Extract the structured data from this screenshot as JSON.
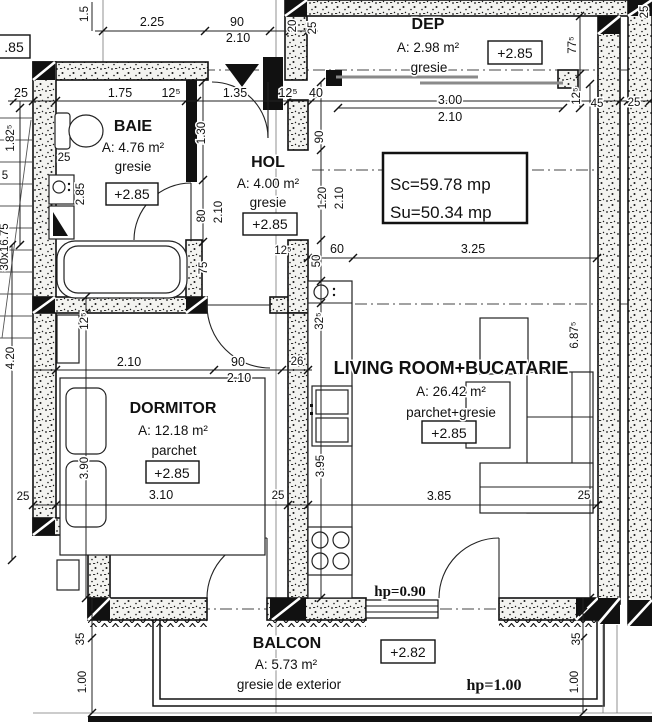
{
  "rooms": {
    "baie": {
      "name": "BAIE",
      "area": "A: 4.76 m²",
      "floor": "gresie",
      "level": "+2.85"
    },
    "hol": {
      "name": "HOL",
      "area": "A: 4.00 m²",
      "floor": "gresie",
      "level": "+2.85"
    },
    "dep": {
      "name": "DEP",
      "area": "A: 2.98 m²",
      "floor": "gresie",
      "level": "+2.85"
    },
    "dormitor": {
      "name": "DORMITOR",
      "area": "A: 12.18 m²",
      "floor": "parchet",
      "level": "+2.85"
    },
    "living": {
      "name": "LIVING ROOM+BUCATARIE",
      "area": "A: 26.42 m²",
      "floor": "parchet+gresie",
      "level": "+2.85"
    },
    "balcon": {
      "name": "BALCON",
      "area": "A: 5.73 m²",
      "floor": "gresie de exterior",
      "level": "+2.82"
    }
  },
  "summary": {
    "sc": "Sc=59.78 mp",
    "su": "Su=50.34 mp"
  },
  "notes": {
    "window_parapet": "hp=0.90",
    "balcony_parapet": "hp=1.00",
    "stair": "30x16.75",
    "level_cut": ".85",
    "partial": "5"
  },
  "dims": {
    "d01": "1.5",
    "d02": "2.25",
    "d03": "90",
    "d04": "2.10",
    "d05": "20",
    "d06": "25",
    "d08": "25",
    "d09": "1.75",
    "d10": "12⁵",
    "d11": "1.35",
    "d12": "12⁵",
    "d13": "40",
    "d14": "3.00",
    "d15": "2.10",
    "d16": "45",
    "d17": "25",
    "d18": "77⁵",
    "d19": "12⁵",
    "d20": "25",
    "d21": "1.82⁵",
    "d22": "25",
    "d23": "2.85",
    "d25": "1.30",
    "d26": "80",
    "d27": "2.10",
    "d28": "90",
    "d29": "1.20",
    "d30": "2.10",
    "d31": "12⁵",
    "d32": "50",
    "d33": "60",
    "d34": "3.25",
    "d35": "32⁵",
    "d36": "75",
    "d37": "12⁵",
    "d38": "4.20",
    "d39": "2.10",
    "d40": "90",
    "d41": "2.10",
    "d42": "26",
    "d43": "6.87⁵",
    "d44": "3.95",
    "d45": "3.90",
    "d46": "25",
    "d47": "3.10",
    "d48": "25",
    "d49": "3.85",
    "d50": "25",
    "d51": "35",
    "d52": "1.00",
    "d53": "35",
    "d54": "1.00"
  }
}
